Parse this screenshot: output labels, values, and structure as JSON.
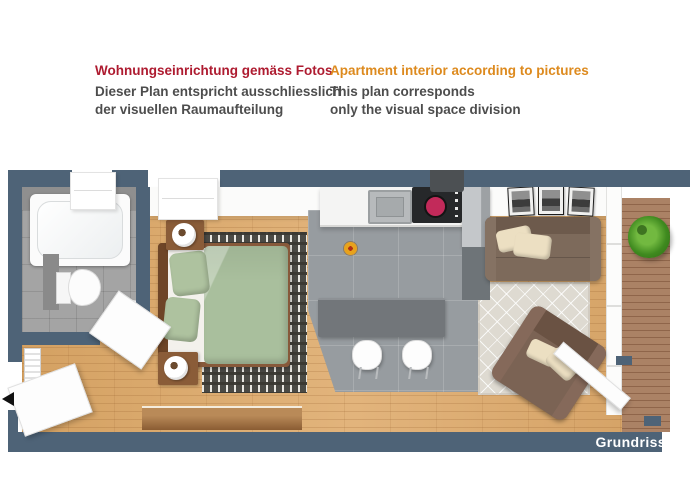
{
  "header": {
    "de": {
      "title": "Wohnungseinrichtung gemäss Fotos",
      "line1": "Dieser Plan entspricht ausschliesslich",
      "line2": "der visuellen Raumaufteilung",
      "title_color": "#ae1b30"
    },
    "en": {
      "title": "Apartment interior according to pictures",
      "line1": "This plan corresponds",
      "line2": "only the visual space division",
      "title_color": "#dd8a1e"
    },
    "body_color": "#4d4d4d"
  },
  "plan": {
    "label": "Grundriss",
    "colors": {
      "wall": "#4e6377",
      "wood_floor": "#d9a76b",
      "bathroom_tile": "#a4a4a4",
      "kitchen_tile": "#979ca0",
      "bar_counter": "#72767a",
      "counter": "#f4f4f3",
      "bed_green": "#a9bf9d",
      "furniture_wood": "#87593a",
      "sofa_brown": "#7d6a5b",
      "pillow_cream": "#ecdfc2",
      "rug_beige": "#dedad1",
      "rug_dark": "#4b4a45",
      "balcony_deck": "#ab8265",
      "plant_green": "#3f8a1f",
      "burner_red": "#c22a5a"
    },
    "rooms": [
      "bathroom",
      "hallway",
      "bedroom",
      "kitchen",
      "living-room",
      "balcony"
    ],
    "furniture": [
      "bathtub",
      "toilet",
      "washbasin",
      "radiator",
      "entrance-door",
      "bathroom-door",
      "double-bed",
      "nightstand-with-lamp",
      "striped-rug",
      "sideboard",
      "kitchen-counter",
      "sink",
      "cooktop",
      "extractor-hood",
      "tall-cabinet",
      "bar-counter",
      "bar-stools",
      "flower-decoration",
      "sofa",
      "wall-pictures",
      "diamond-rug",
      "glass-coffee-table",
      "armchair",
      "potted-plant",
      "balcony-door",
      "wooden-deck"
    ]
  }
}
